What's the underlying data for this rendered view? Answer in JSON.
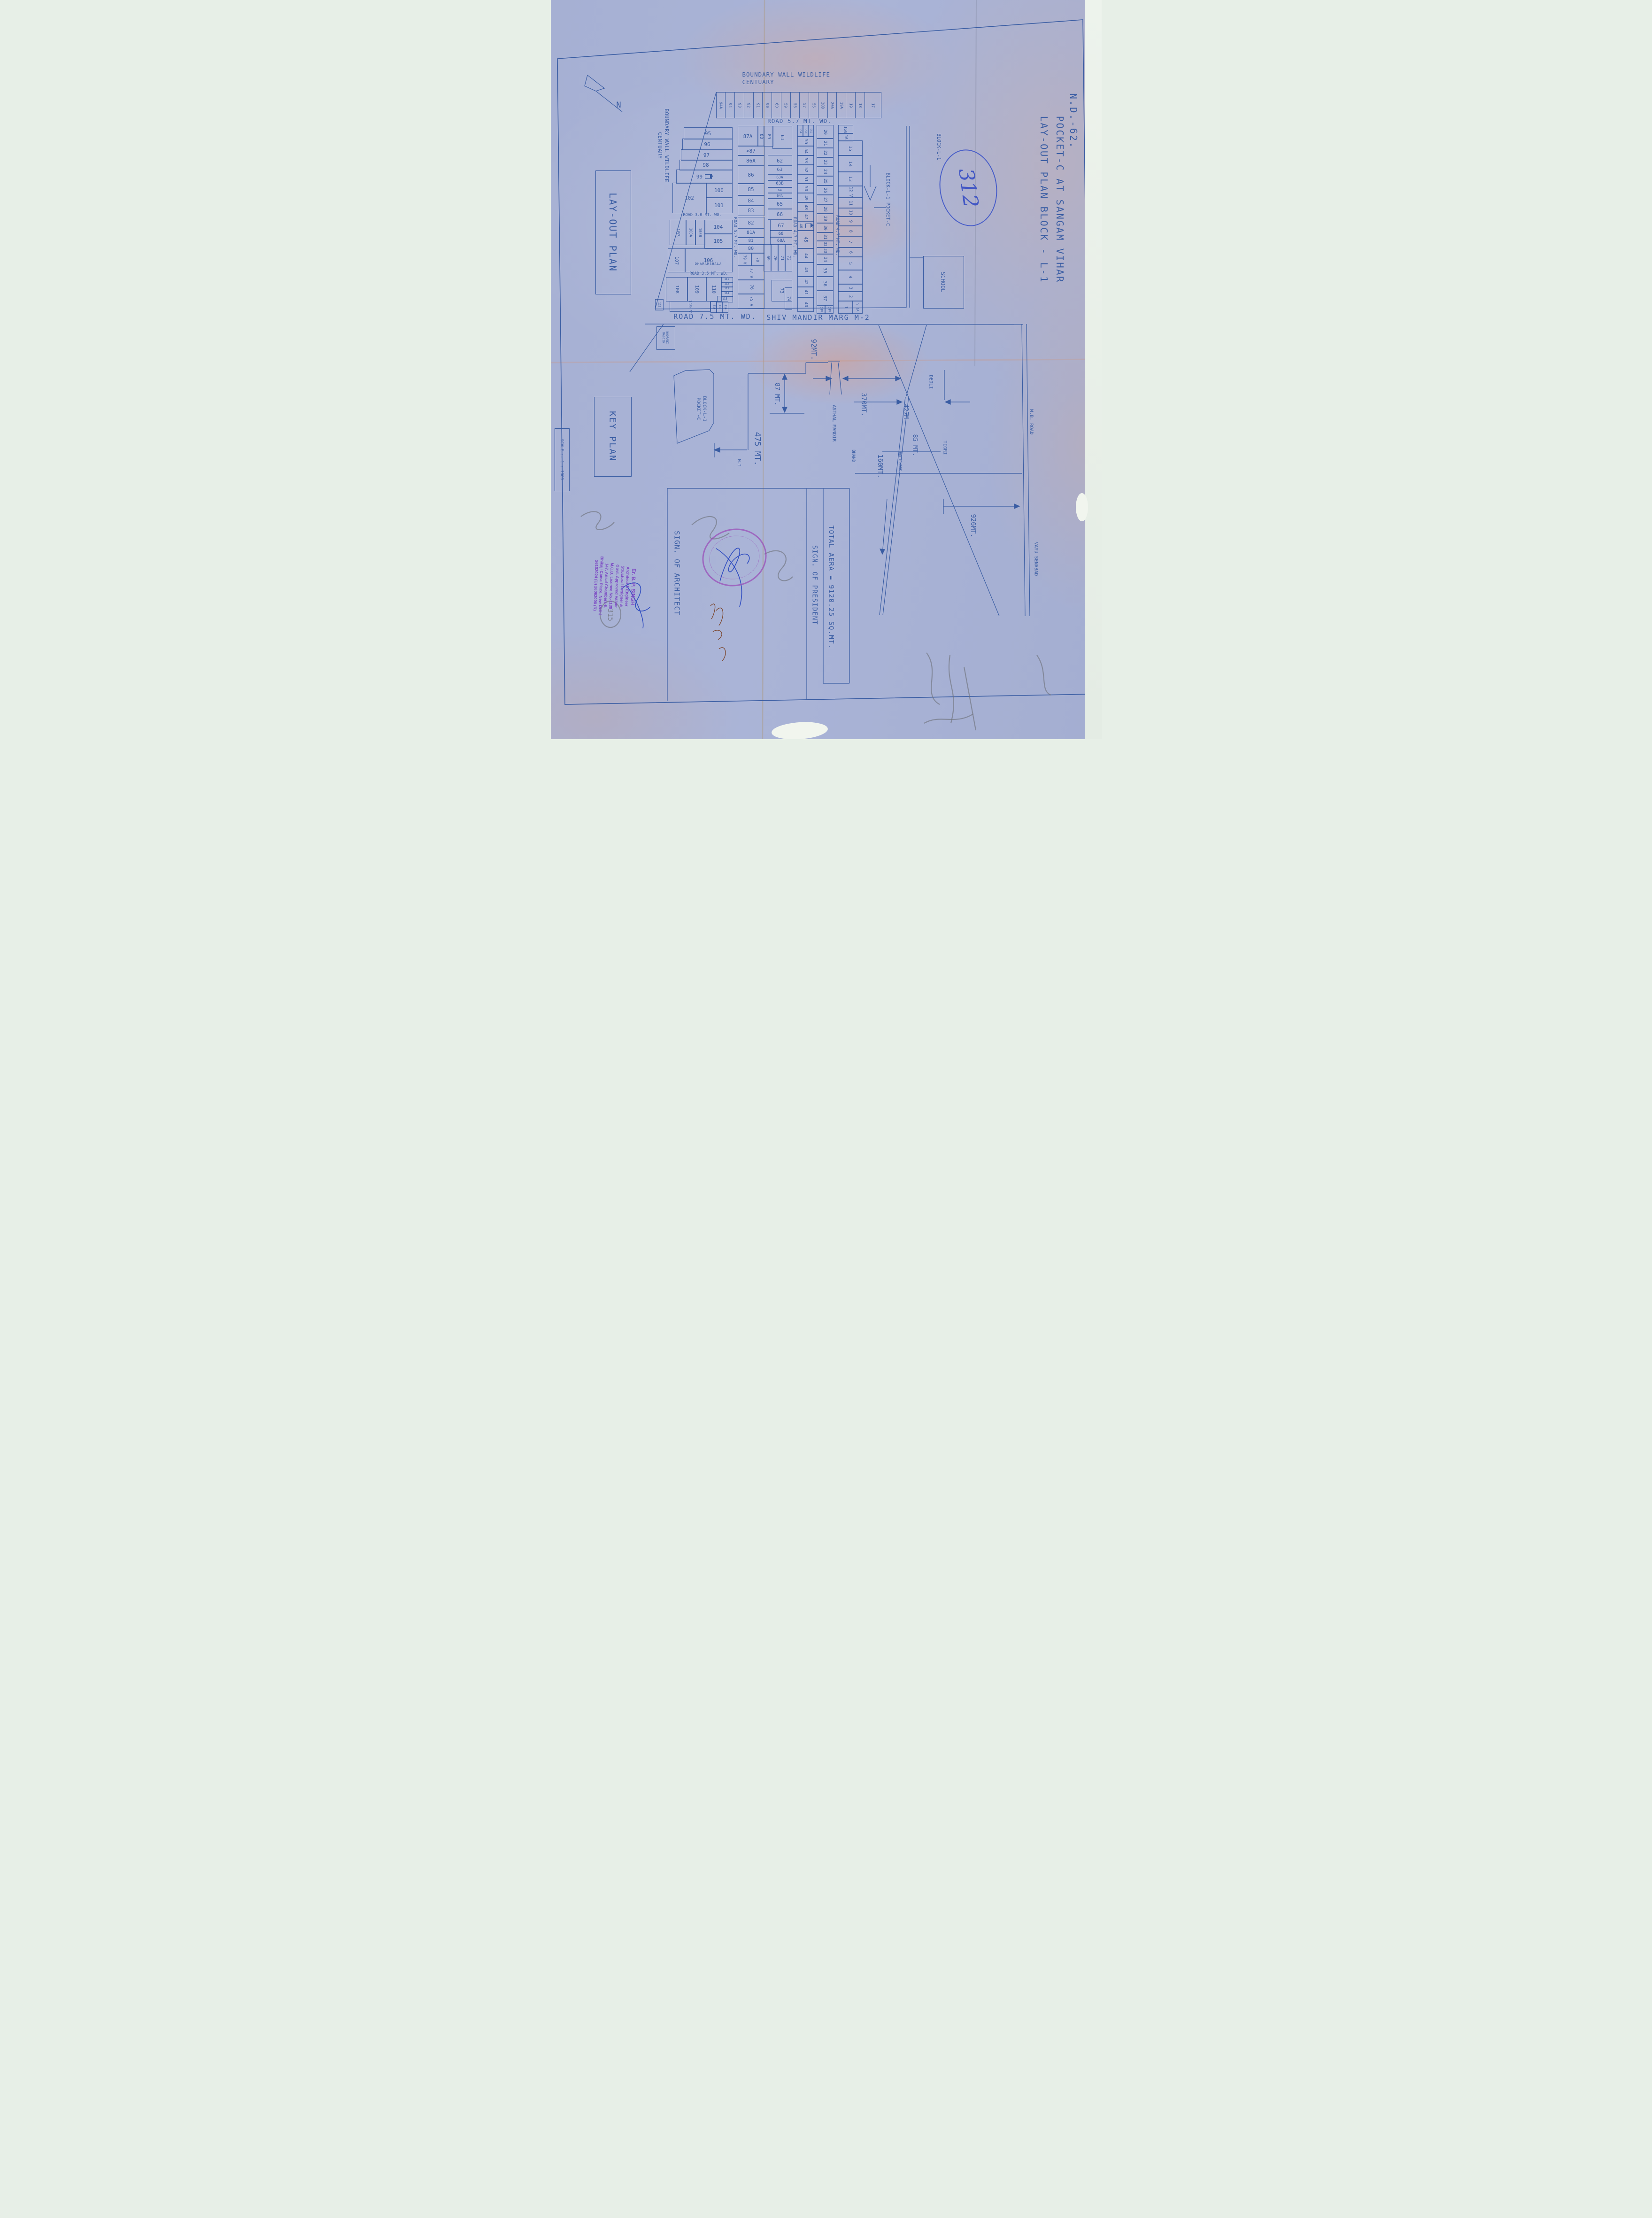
{
  "title": {
    "line1": "LAY-OUT PLAN BLOCK - L-1",
    "line2": "POCKET-C AT SANGAM VIHAR",
    "line3": "N.D.-62."
  },
  "labels": {
    "north": "N",
    "layout_plan": "LAY-OUT PLAN",
    "key_plan": "KEY PLAN",
    "scale": "SCALE :- 1 : 1000",
    "boundary": "BOUNDARY WALL WILDLIFE\nCENTUARY",
    "road57": "ROAD 5.7 MT. WD.",
    "road30": "ROAD 3.0 MT. WD.",
    "road35": "ROAD 3.5 MT. WD.",
    "road75": "ROAD 7.5 MT. WD.",
    "shiv_marg": "SHIV MANDIR MARG M-2",
    "block_l1": "BLOCK-L-1",
    "block_l1_pocket": "BLOCK-L-1 POCKET-C",
    "keyplan_block": "BLOCK-L-1\nPOCKET-C",
    "school": "SCHOOL",
    "noorani": "NOORANI\nMASJID",
    "asthal": "ASTHAL MANDIR",
    "bhand": "BHAND",
    "holichook": "HOLICHOOK",
    "tigri": "TIGRI",
    "deoli": "DEOLI",
    "mb_road": "M.B. ROAD",
    "vayu": "VAYU SENABAD",
    "m1": "M-I"
  },
  "dims": {
    "d92": "92MT.",
    "d87": "87 MT.",
    "d370": "370MT.",
    "d475": "475 MT.",
    "d427": "427M",
    "d85": "85 MT.",
    "d160": "160MT.",
    "d926": "926MT."
  },
  "table": {
    "sign_architect": "SIGN. OF ARCHITECT",
    "total_area": "TOTAL AERA = 9120.25 SQ.MT.",
    "sign_president": "SIGN. OF PRESIDENT"
  },
  "annotations": {
    "circled_number": "312",
    "pencil_number": "315"
  },
  "stamp": {
    "lines": [
      "Er. B. P. SINGH",
      "Architect & Engineer",
      "Structural Designer &",
      "Govt. Approved Valuer",
      "M.C.D. Licence No.-1138",
      "147, Ansal Chambers-II,",
      "Bhikaji Cama Place, New Delhi",
      "26102024 (O)  26062008 (R)"
    ]
  },
  "plots": {
    "top_row": [
      "94A",
      "94",
      "93",
      "92",
      "91",
      "90",
      "60",
      "59",
      "58",
      "57",
      "56",
      "20B",
      "20A",
      "19A",
      "19",
      "18",
      "17"
    ],
    "road_labels": [
      [
        "ROAD 5.7 MT. WD.",
        384,
        428,
        155,
        9
      ],
      [
        "ROAD 4.7 MT. WD.",
        511,
        428,
        155,
        9
      ],
      [
        "ROAD 4.7 MT. WD.",
        602,
        422,
        160,
        9
      ]
    ],
    "cells": [
      [
        "95",
        283,
        271,
        102,
        24,
        0,
        11
      ],
      [
        "96",
        280,
        295,
        105,
        23,
        0,
        11
      ],
      [
        "97",
        277,
        318,
        108,
        22,
        0,
        11
      ],
      [
        "98",
        274,
        340,
        111,
        21,
        0,
        11
      ],
      [
        "99",
        267,
        361,
        118,
        28,
        0,
        11,
        "pump"
      ],
      [
        "102",
        259,
        389,
        71,
        63,
        0,
        11
      ],
      [
        "100",
        330,
        389,
        55,
        31,
        0,
        11
      ],
      [
        "101",
        330,
        420,
        55,
        32,
        0,
        11
      ],
      [
        "103",
        253,
        468,
        34,
        52,
        1,
        10
      ],
      [
        "103A",
        287,
        468,
        20,
        52,
        1,
        8
      ],
      [
        "103B",
        307,
        468,
        20,
        52,
        1,
        8
      ],
      [
        "104",
        327,
        468,
        58,
        29,
        0,
        11
      ],
      [
        "105",
        327,
        497,
        58,
        30,
        0,
        11
      ],
      [
        "107",
        249,
        529,
        36,
        49,
        1,
        10
      ],
      [
        "106",
        285,
        529,
        100,
        49,
        0,
        11,
        null,
        "DHARAMSHALA"
      ],
      [
        "108",
        245,
        590,
        45,
        50,
        1,
        10
      ],
      [
        "109",
        290,
        590,
        40,
        50,
        1,
        10
      ],
      [
        "110",
        330,
        590,
        32,
        50,
        1,
        10
      ],
      [
        "111",
        362,
        590,
        24,
        10,
        0,
        5.5
      ],
      [
        "112",
        362,
        600,
        24,
        10,
        0,
        5.5
      ],
      [
        "113",
        362,
        610,
        24,
        10,
        0,
        5.5
      ],
      [
        "114",
        362,
        620,
        24,
        10,
        0,
        5.5
      ],
      [
        "115",
        354,
        630,
        32,
        12,
        0,
        6
      ],
      [
        "118",
        340,
        642,
        12,
        22,
        1,
        5.5
      ],
      [
        "117",
        352,
        642,
        12,
        22,
        1,
        5.5
      ],
      [
        "116",
        364,
        642,
        12,
        22,
        1,
        5.5
      ],
      [
        "119 V",
        253,
        641,
        85,
        21,
        1,
        9
      ],
      [
        "120",
        222,
        637,
        16,
        22,
        1,
        6
      ],
      [
        "87A",
        398,
        268,
        42,
        42,
        0,
        11
      ],
      [
        "88",
        440,
        268,
        13,
        42,
        1,
        9
      ],
      [
        "<87",
        398,
        310,
        55,
        20,
        0,
        11
      ],
      [
        "86A",
        398,
        330,
        55,
        22,
        0,
        11
      ],
      [
        "86",
        398,
        352,
        55,
        38,
        0,
        11
      ],
      [
        "85",
        398,
        390,
        55,
        25,
        0,
        11
      ],
      [
        "84",
        398,
        415,
        55,
        22,
        0,
        11
      ],
      [
        "83",
        398,
        437,
        55,
        21,
        0,
        11
      ],
      [
        "82",
        398,
        462,
        55,
        23,
        0,
        11
      ],
      [
        "81A",
        398,
        485,
        55,
        20,
        0,
        10
      ],
      [
        "81",
        398,
        505,
        55,
        15,
        0,
        9
      ],
      [
        "80",
        398,
        520,
        55,
        18,
        0,
        10
      ],
      [
        "79 V",
        398,
        538,
        28,
        27,
        1,
        8
      ],
      [
        "78",
        426,
        538,
        27,
        27,
        1,
        8
      ],
      [
        "77 V",
        398,
        565,
        55,
        30,
        1,
        9
      ],
      [
        "76",
        398,
        595,
        55,
        30,
        1,
        9
      ],
      [
        "75 V",
        398,
        625,
        55,
        31,
        1,
        9
      ],
      [
        "89",
        453,
        268,
        19,
        42,
        1,
        9
      ],
      [
        "61",
        472,
        268,
        40,
        47,
        1,
        10
      ],
      [
        "62",
        462,
        330,
        50,
        22,
        0,
        11
      ],
      [
        "63",
        462,
        352,
        50,
        18,
        0,
        10
      ],
      [
        "63A",
        462,
        370,
        50,
        13,
        0,
        8
      ],
      [
        "63B",
        462,
        383,
        50,
        15,
        0,
        9
      ],
      [
        "64",
        462,
        398,
        50,
        12,
        0,
        7
      ],
      [
        "64A",
        462,
        410,
        50,
        12,
        0,
        7
      ],
      [
        "65",
        462,
        422,
        50,
        22,
        0,
        11
      ],
      [
        "66",
        462,
        444,
        50,
        22,
        0,
        11
      ],
      [
        "67",
        467,
        468,
        45,
        22,
        0,
        11
      ],
      [
        "68",
        467,
        490,
        45,
        14,
        0,
        9
      ],
      [
        "68A",
        467,
        504,
        45,
        16,
        0,
        9
      ],
      [
        "69",
        453,
        520,
        15,
        56,
        1,
        9
      ],
      [
        "70",
        468,
        520,
        15,
        56,
        1,
        9
      ],
      [
        "71",
        483,
        520,
        15,
        56,
        1,
        9
      ],
      [
        "72",
        498,
        520,
        14,
        56,
        1,
        9
      ],
      [
        "73",
        470,
        596,
        42,
        44,
        1,
        10
      ],
      [
        "74",
        498,
        612,
        14,
        46,
        1,
        9
      ],
      [
        "55A",
        525,
        266,
        11,
        24,
        1,
        5.5
      ],
      [
        "55B",
        536,
        266,
        11,
        24,
        1,
        5.5
      ],
      [
        "55C",
        547,
        266,
        11,
        24,
        1,
        5.5
      ],
      [
        "55",
        525,
        290,
        33,
        20,
        1,
        9
      ],
      [
        "54",
        525,
        310,
        33,
        20,
        1,
        9
      ],
      [
        "53",
        525,
        330,
        33,
        20,
        1,
        9
      ],
      [
        "52",
        525,
        350,
        33,
        20,
        1,
        9
      ],
      [
        "51",
        525,
        370,
        33,
        20,
        1,
        9
      ],
      [
        "50",
        525,
        390,
        33,
        20,
        1,
        9
      ],
      [
        "49",
        525,
        410,
        33,
        20,
        1,
        9
      ],
      [
        "48",
        525,
        430,
        33,
        20,
        1,
        9
      ],
      [
        "47",
        525,
        450,
        33,
        20,
        1,
        9
      ],
      [
        "46",
        525,
        470,
        33,
        20,
        1,
        8,
        "pump"
      ],
      [
        "45",
        525,
        490,
        33,
        38,
        1,
        10
      ],
      [
        "44",
        525,
        528,
        33,
        30,
        1,
        9
      ],
      [
        "43",
        525,
        558,
        33,
        30,
        1,
        9
      ],
      [
        "42",
        525,
        588,
        33,
        22,
        1,
        9
      ],
      [
        "41",
        525,
        610,
        33,
        22,
        1,
        9
      ],
      [
        "40",
        525,
        632,
        33,
        30,
        1,
        9
      ],
      [
        "20",
        566,
        266,
        34,
        28,
        1,
        9
      ],
      [
        "21",
        566,
        294,
        34,
        20,
        1,
        9
      ],
      [
        "22",
        566,
        314,
        34,
        20,
        1,
        9
      ],
      [
        "23",
        566,
        334,
        34,
        20,
        1,
        9
      ],
      [
        "24",
        566,
        354,
        34,
        20,
        1,
        9
      ],
      [
        "25",
        566,
        374,
        34,
        20,
        1,
        9
      ],
      [
        "26",
        566,
        394,
        34,
        20,
        1,
        9
      ],
      [
        "27",
        566,
        414,
        34,
        20,
        1,
        9
      ],
      [
        "28",
        566,
        434,
        34,
        20,
        1,
        9
      ],
      [
        "29",
        566,
        454,
        34,
        20,
        1,
        9
      ],
      [
        "30",
        566,
        474,
        34,
        20,
        1,
        9
      ],
      [
        "31",
        566,
        494,
        34,
        18,
        1,
        9
      ],
      [
        "32",
        566,
        512,
        34,
        14,
        1,
        8
      ],
      [
        "33",
        566,
        526,
        34,
        14,
        1,
        8
      ],
      [
        "34",
        566,
        540,
        34,
        22,
        1,
        9
      ],
      [
        "35",
        566,
        562,
        34,
        26,
        1,
        10
      ],
      [
        "36",
        566,
        588,
        34,
        30,
        1,
        10
      ],
      [
        "37",
        566,
        618,
        34,
        32,
        1,
        10
      ],
      [
        "39V",
        566,
        650,
        17,
        16,
        1,
        6
      ],
      [
        "38V",
        583,
        650,
        17,
        16,
        1,
        6
      ],
      [
        "16A",
        612,
        266,
        30,
        17,
        1,
        8
      ],
      [
        "16",
        612,
        283,
        30,
        16,
        1,
        8
      ],
      [
        "15",
        612,
        299,
        50,
        31,
        1,
        10
      ],
      [
        "14",
        612,
        330,
        50,
        35,
        1,
        10
      ],
      [
        "13",
        612,
        365,
        50,
        30,
        1,
        10
      ],
      [
        "12 V",
        612,
        395,
        50,
        25,
        1,
        9
      ],
      [
        "11",
        612,
        420,
        50,
        22,
        1,
        9
      ],
      [
        "10",
        612,
        442,
        50,
        18,
        1,
        9
      ],
      [
        "9",
        612,
        460,
        50,
        20,
        1,
        9
      ],
      [
        "8",
        612,
        480,
        50,
        22,
        1,
        9
      ],
      [
        "7",
        612,
        502,
        50,
        24,
        1,
        10
      ],
      [
        "6",
        612,
        526,
        50,
        20,
        1,
        9
      ],
      [
        "5",
        612,
        546,
        50,
        28,
        1,
        10
      ],
      [
        "4",
        612,
        574,
        50,
        30,
        1,
        10
      ],
      [
        "3",
        612,
        604,
        50,
        16,
        1,
        9
      ],
      [
        "2",
        612,
        620,
        50,
        20,
        1,
        9
      ],
      [
        "1",
        612,
        640,
        30,
        26,
        1,
        9
      ],
      [
        "V 1A",
        642,
        640,
        20,
        26,
        1,
        7
      ]
    ]
  }
}
